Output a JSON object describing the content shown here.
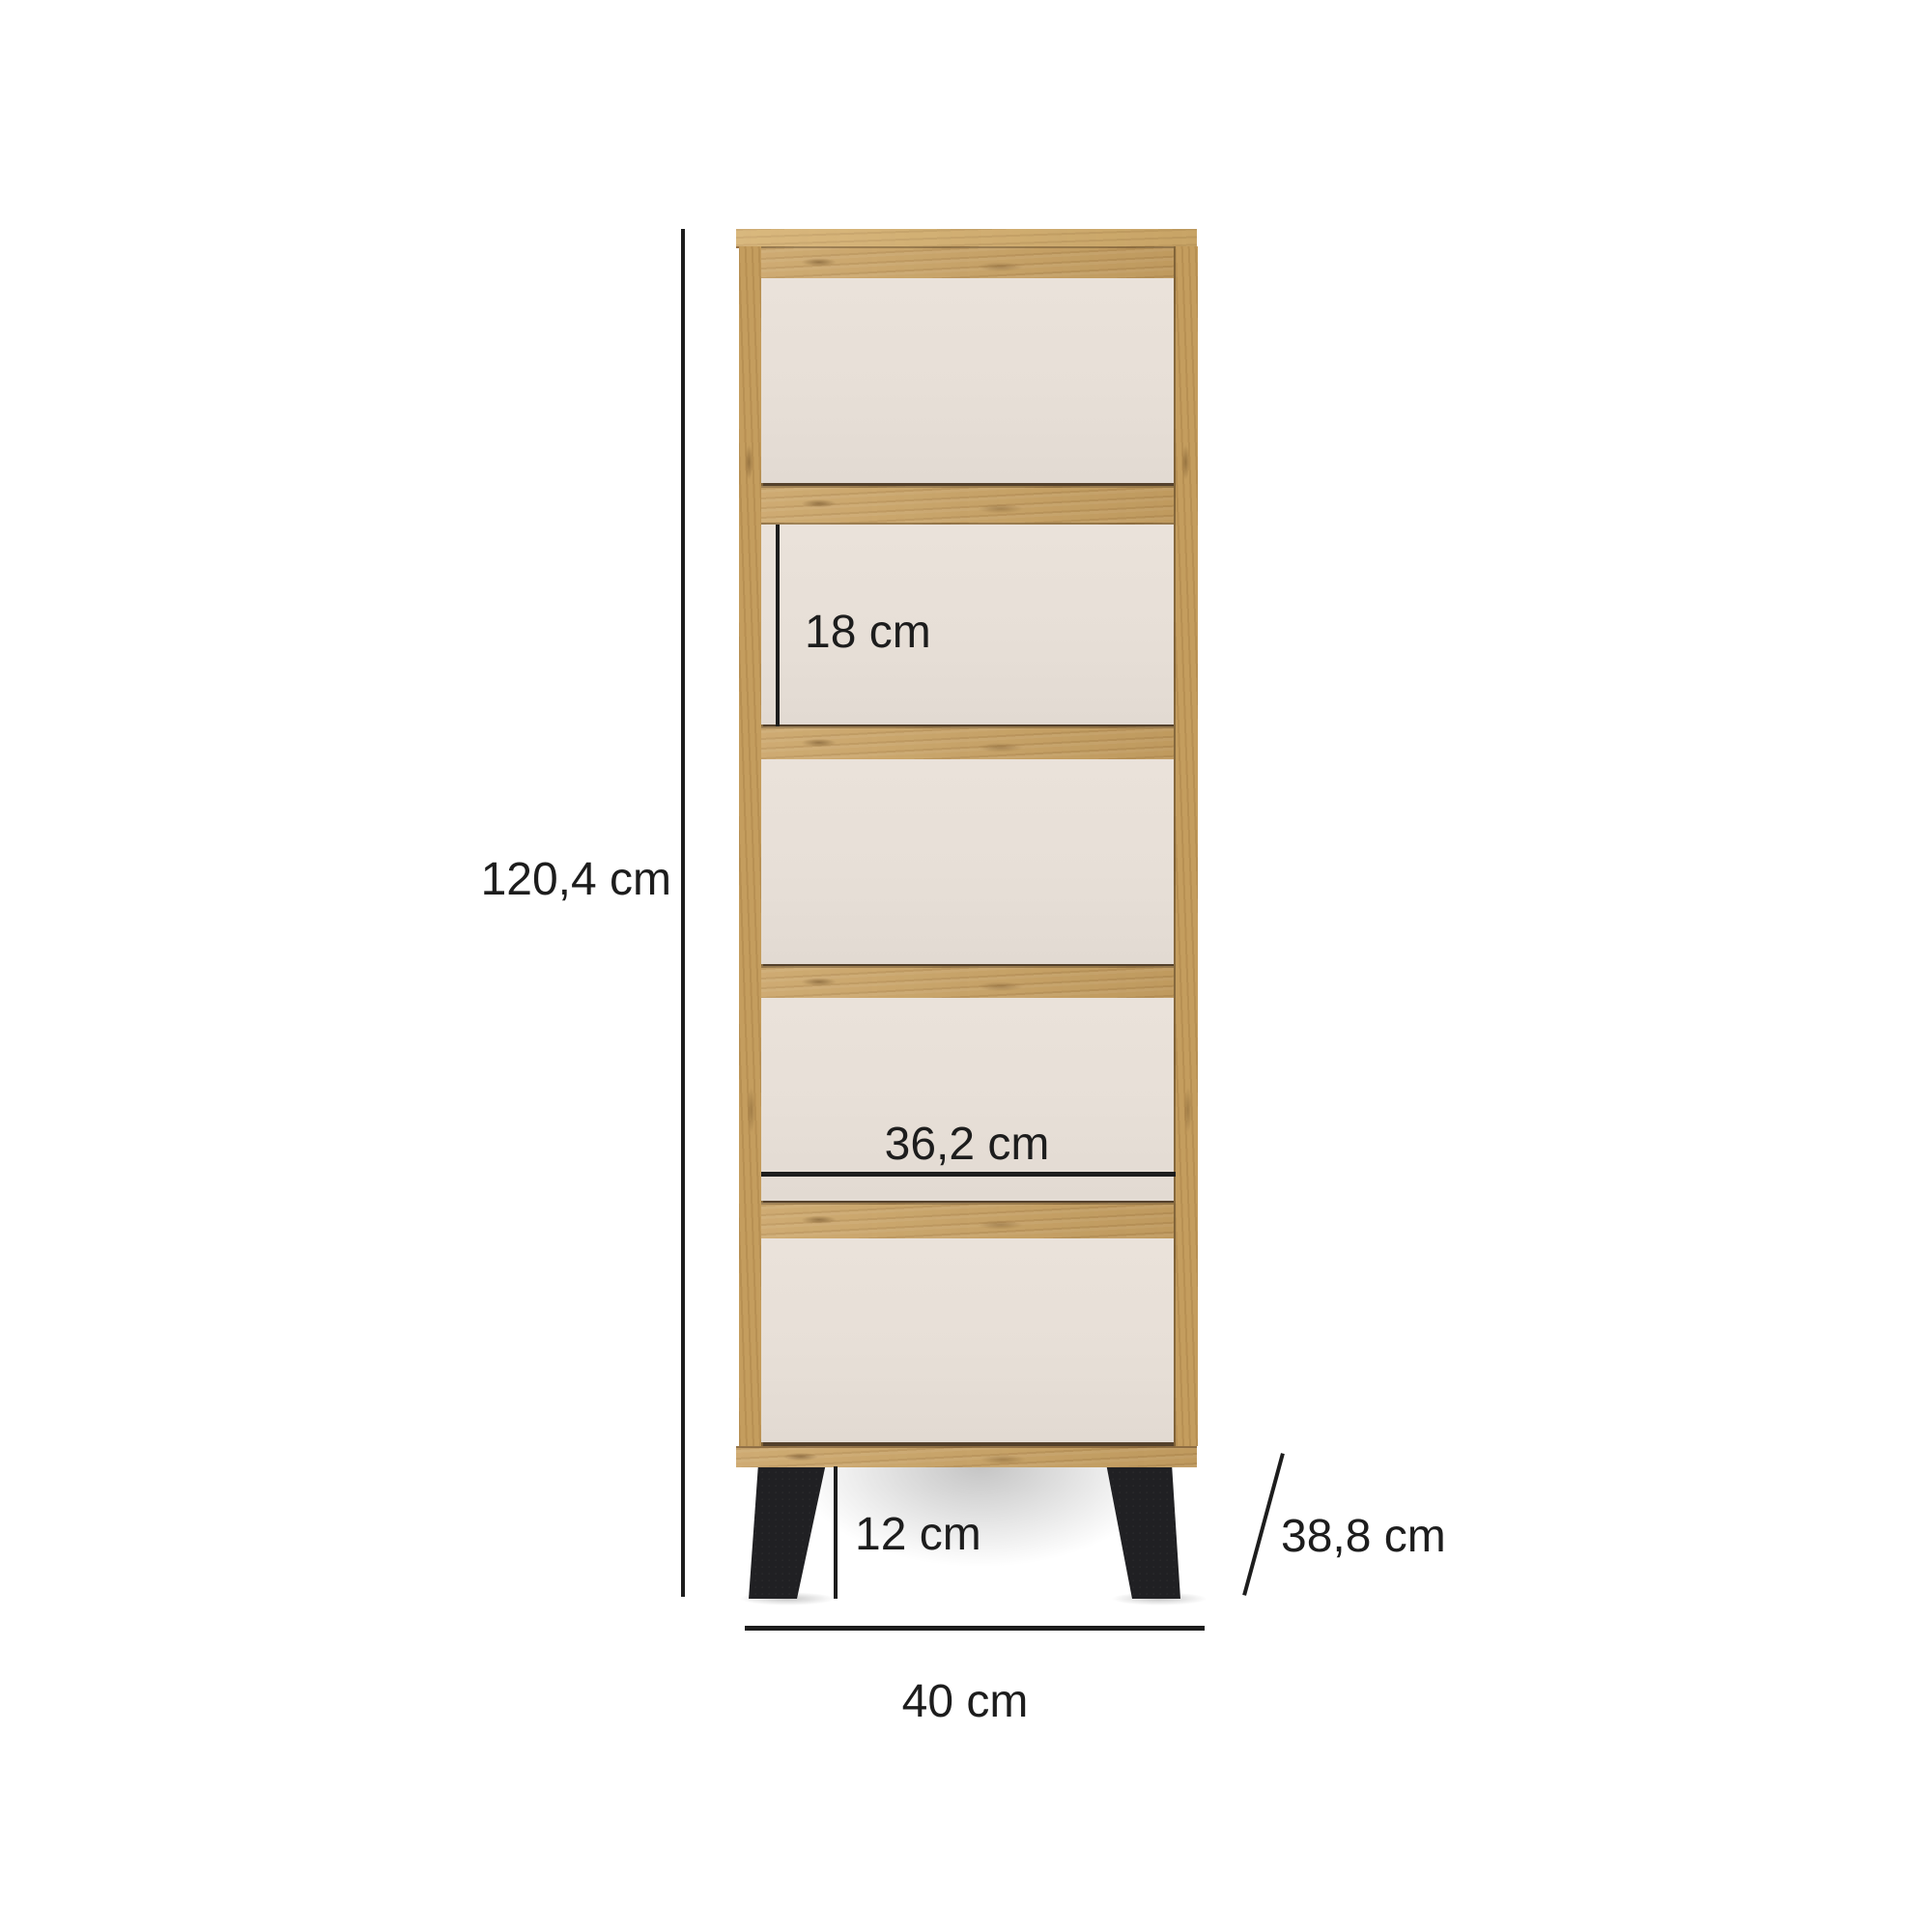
{
  "diagram": {
    "type": "furniture-dimension-diagram",
    "item": "chest-of-drawers",
    "drawer_count": 5,
    "dimensions": {
      "height": "120,4 cm",
      "drawer_front_height": "18 cm",
      "drawer_front_width": "36,2 cm",
      "leg_height": "12 cm",
      "depth": "38,8 cm",
      "width": "40 cm"
    },
    "colors": {
      "wood": "#c9a263",
      "wood-light": "#d4ae6c",
      "panel": "#e7dfd7",
      "legs": "#202023",
      "dim": "#1d1d1d",
      "bg": "#ffffff"
    }
  }
}
